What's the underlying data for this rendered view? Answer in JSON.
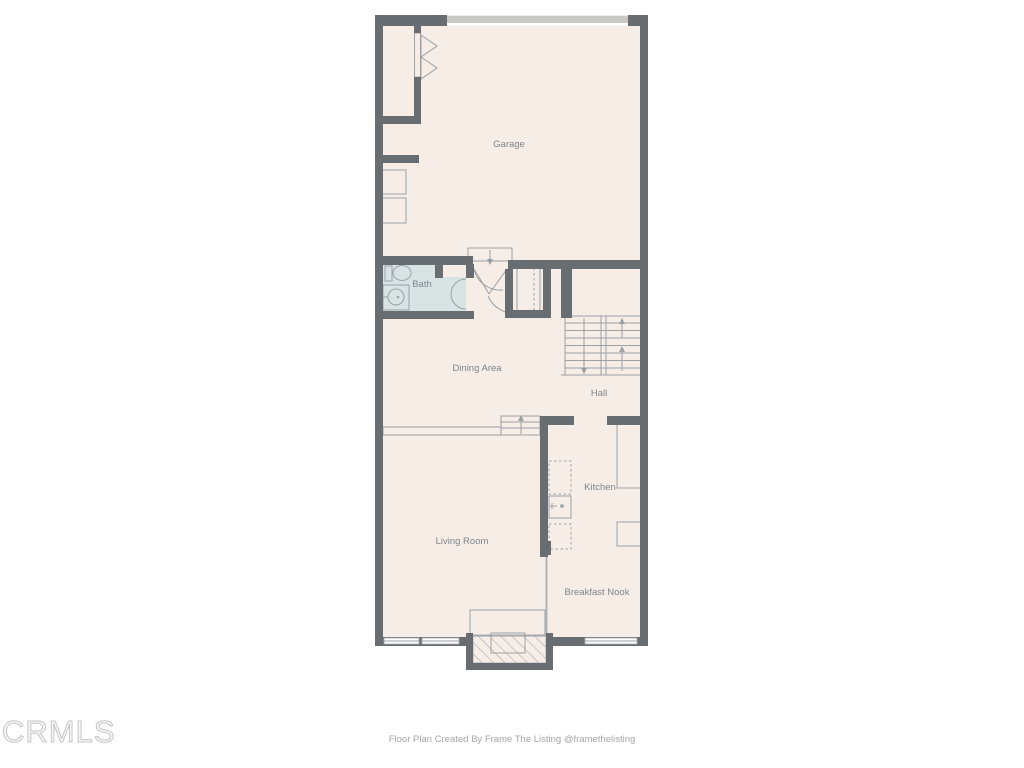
{
  "theme": {
    "canvas_bg": "#ffffff",
    "wall_color": "#686d72",
    "floor_color": "#f6ede7",
    "bath_floor_color": "#d8e4e4",
    "line_color": "#9aa0a4",
    "label_color": "#7e858a",
    "garage_door_color": "#c9c8c5"
  },
  "watermark": {
    "text": "CRMLS"
  },
  "footer": {
    "credit": "Floor Plan Created By Frame The Listing @framethelisting"
  },
  "floor_plan": {
    "rooms": [
      {
        "label": "Garage"
      },
      {
        "label": "Bath"
      },
      {
        "label": "Dining Area"
      },
      {
        "label": "Hall"
      },
      {
        "label": "Kitchen"
      },
      {
        "label": "Living Room"
      },
      {
        "label": "Breakfast Nook"
      }
    ],
    "symbols": [
      "garage-door",
      "bifold-closet-door",
      "washer-box",
      "dryer-box",
      "entry-landing-step",
      "entry-door-swings",
      "coat-closet-rod",
      "toilet",
      "vanity-sink",
      "bath-door-swing",
      "stairs-up",
      "stairs-down",
      "half-wall-ledge",
      "step-up-arrow",
      "kitchen-sink",
      "kitchen-counters",
      "fireplace-hearth",
      "windows"
    ]
  }
}
